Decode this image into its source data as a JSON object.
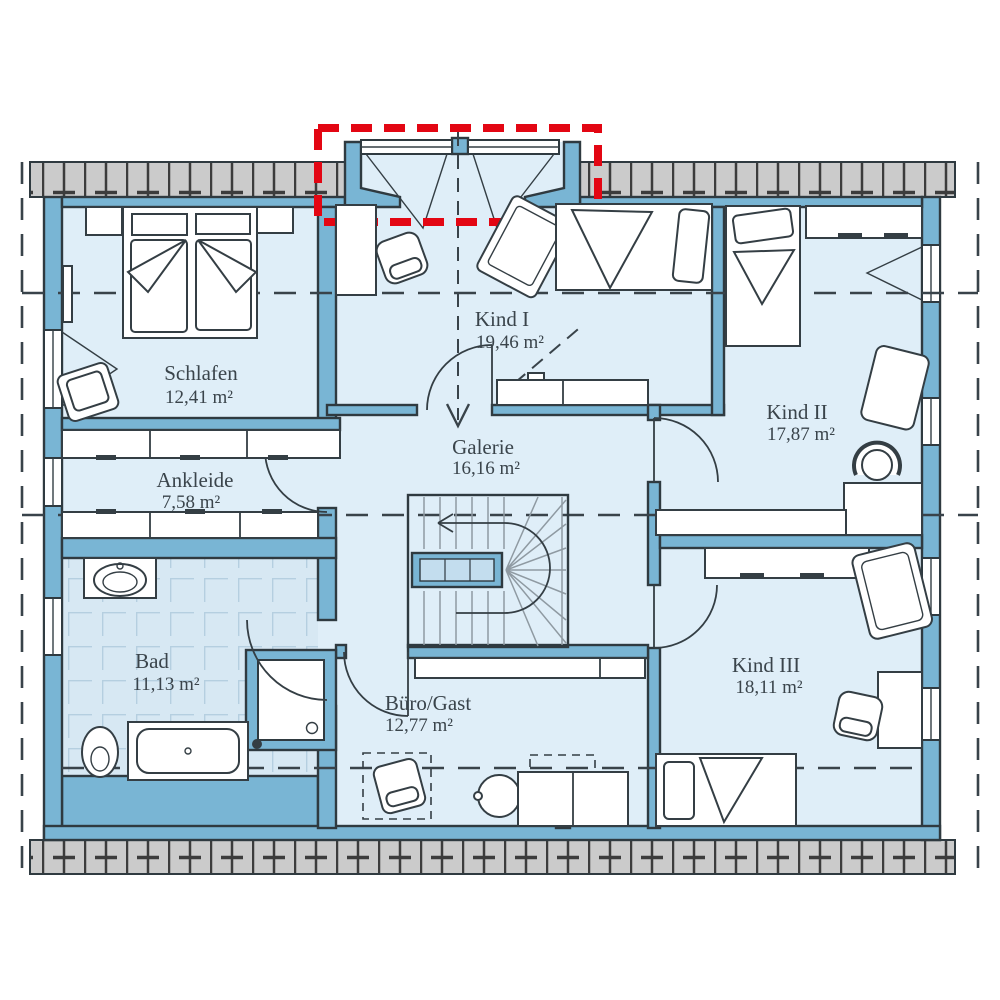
{
  "plan": {
    "rooms": [
      {
        "id": "schlafen",
        "name": "Schlafen",
        "area": "12,41 m²"
      },
      {
        "id": "ankleide",
        "name": "Ankleide",
        "area": "7,58 m²"
      },
      {
        "id": "bad",
        "name": "Bad",
        "area": "11,13 m²"
      },
      {
        "id": "kind1",
        "name": "Kind I",
        "area": "19,46 m²"
      },
      {
        "id": "galerie",
        "name": "Galerie",
        "area": "16,16 m²"
      },
      {
        "id": "kind2",
        "name": "Kind II",
        "area": "17,87 m²"
      },
      {
        "id": "buero",
        "name": "Büro/Gast",
        "area": "12,77 m²"
      },
      {
        "id": "kind3",
        "name": "Kind III",
        "area": "18,11 m²"
      }
    ]
  },
  "colors": {
    "wall-blue": "#79b5d4",
    "wall-outline": "#2f3a40",
    "room-fill": "#dfeef8",
    "tile-fill": "#d7e8f3",
    "tile-line": "#b5cfe0",
    "roof-gray": "#cbcbcb",
    "roof-line": "#3c3c3c",
    "accent-red": "#e30613",
    "stair-line": "#8f9aa2",
    "dash-line": "#39434a",
    "text": "#3a444b",
    "furn": "#343e44",
    "railing": "#c3ddee"
  }
}
